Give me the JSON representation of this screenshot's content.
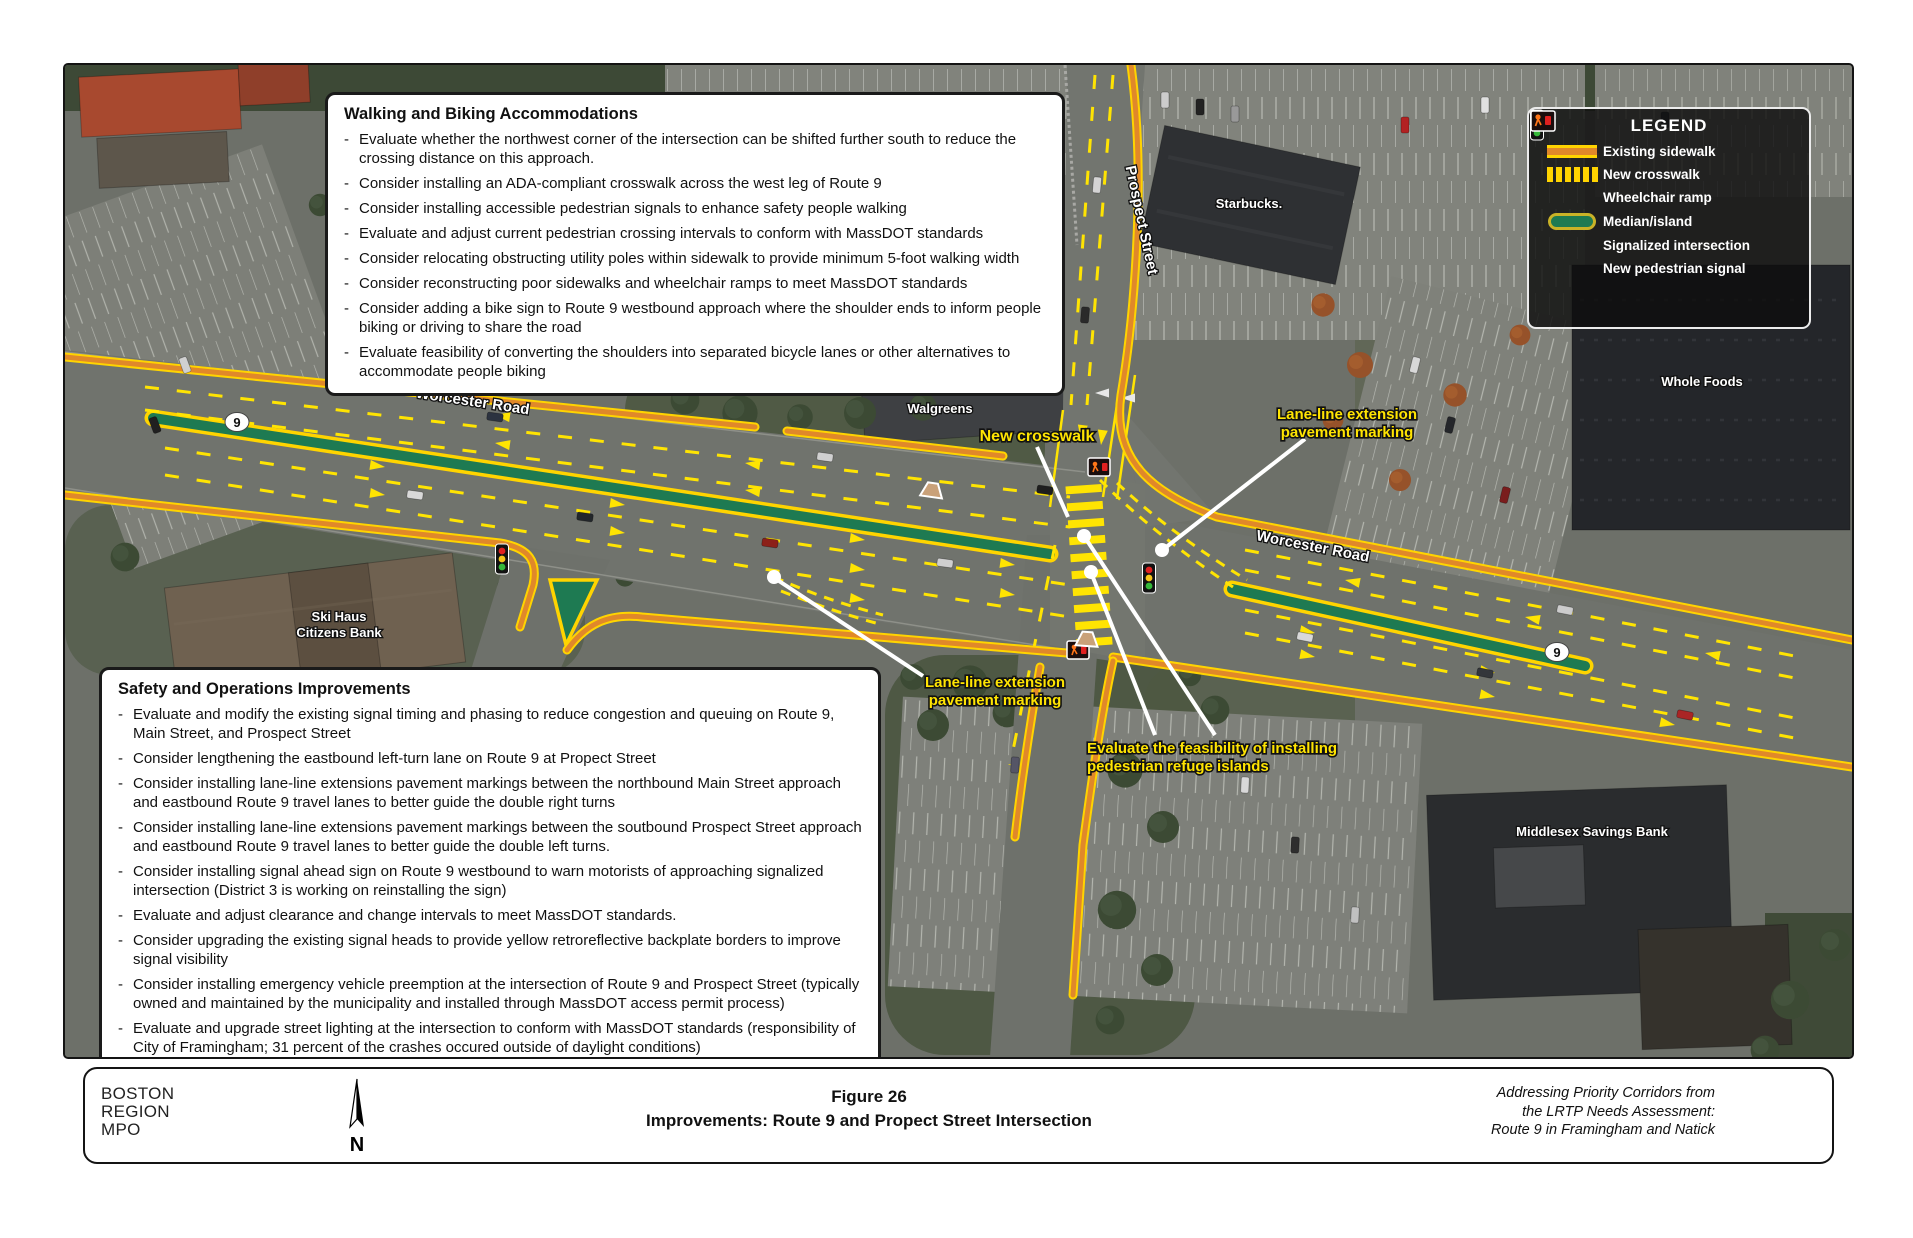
{
  "map": {
    "colors": {
      "sidewalk_orange": "#e0882a",
      "marking_yellow": "#ffe402",
      "sidewalk_border_yellow": "#ffd400",
      "median_green": "#1e7a52",
      "callout_yellow": "#ffe402",
      "asphalt": "#70736d"
    },
    "route_shield": "9",
    "street_labels": {
      "worcester_west": "Worcester Road",
      "worcester_east": "Worcester Road",
      "prospect": "Prospect Street"
    },
    "place_labels": {
      "walgreens": "Walgreens",
      "starbucks": "Starbucks.",
      "whole_foods": "Whole Foods",
      "ski_haus_line1": "Ski Haus",
      "ski_haus_line2": "Citizens Bank",
      "middlesex": "Middlesex Savings Bank"
    },
    "callouts": {
      "new_crosswalk": "New crosswalk",
      "lane_line_ne_line1": "Lane-line extension",
      "lane_line_ne_line2": "pavement marking",
      "lane_line_w_line1": "Lane-line extension",
      "lane_line_w_line2": "pavement marking",
      "refuge_line1": "Evaluate the feasibility of installing",
      "refuge_line2": "pedestrian refuge islands"
    }
  },
  "walking_box": {
    "title": "Walking and Biking Accommodations",
    "items": [
      "Evaluate whether the northwest corner of the intersection can be shifted further south to reduce the crossing distance on this approach.",
      "Consider installing an ADA-compliant crosswalk across the west leg of Route 9",
      "Consider installing accessible pedestrian signals to enhance safety people walking",
      "Evaluate and adjust current pedestrian crossing intervals to conform with MassDOT standards",
      "Consider relocating obstructing utility poles within sidewalk to provide minimum 5-foot walking width",
      "Consider reconstructing poor sidewalks and wheelchair ramps to meet MassDOT standards",
      "Consider adding a bike sign to Route 9 westbound approach where the shoulder ends to inform people biking or driving to share the road",
      "Evaluate feasibility of converting the shoulders into separated bicycle lanes or other alternatives to accommodate people biking"
    ]
  },
  "safety_box": {
    "title": "Safety and Operations Improvements",
    "items": [
      "Evaluate and modify the existing signal timing and phasing to reduce congestion and queuing on Route 9, Main Street, and Prospect Street",
      "Consider lengthening the eastbound left-turn lane on Route 9 at Propect Street",
      "Consider installing lane-line extensions pavement markings between the northbound Main Street approach and eastbound Route 9 travel lanes to better guide the double right turns",
      "Consider installing lane-line extensions pavement markings between the soutbound Prospect Street approach and eastbound Route 9 travel lanes to better guide the double left turns.",
      "Consider installing signal ahead sign on Route 9 westbound to warn motorists of approaching signalized intersection (District 3 is working on reinstalling the sign)",
      "Evaluate and adjust clearance and change intervals to meet MassDOT standards.",
      "Consider upgrading the existing signal heads to provide yellow retroreflective backplate borders to improve signal visibility",
      "Consider installing emergency vehicle preemption at the intersection of Route 9 and Prospect Street (typically owned and maintained by the municipality and installed through MassDOT access permit process)",
      "Evaluate and upgrade street lighting at the intersection to conform with MassDOT standards (responsibility of City of Framingham; 31 percent of the crashes occured outside of daylight conditions)"
    ]
  },
  "legend": {
    "title": "LEGEND",
    "items": [
      {
        "icon": "existing-sidewalk-icon",
        "label": "Existing sidewalk"
      },
      {
        "icon": "new-crosswalk-icon",
        "label": "New crosswalk"
      },
      {
        "icon": "wheelchair-ramp-icon",
        "label": "Wheelchair ramp"
      },
      {
        "icon": "median-island-icon",
        "label": "Median/island"
      },
      {
        "icon": "signalized-intersection-icon",
        "label": "Signalized intersection"
      },
      {
        "icon": "new-pedestrian-signal-icon",
        "label": "New pedestrian signal"
      }
    ]
  },
  "footer": {
    "agency_line1": "BOSTON",
    "agency_line2": "REGION",
    "agency_line3": "MPO",
    "north_label": "N",
    "figure_number": "Figure 26",
    "figure_title": "Improvements: Route 9 and Propect Street Intersection",
    "credit_line1": "Addressing Priority Corridors from",
    "credit_line2": "the LRTP Needs Assessment:",
    "credit_line3": "Route 9 in Framingham and Natick"
  }
}
